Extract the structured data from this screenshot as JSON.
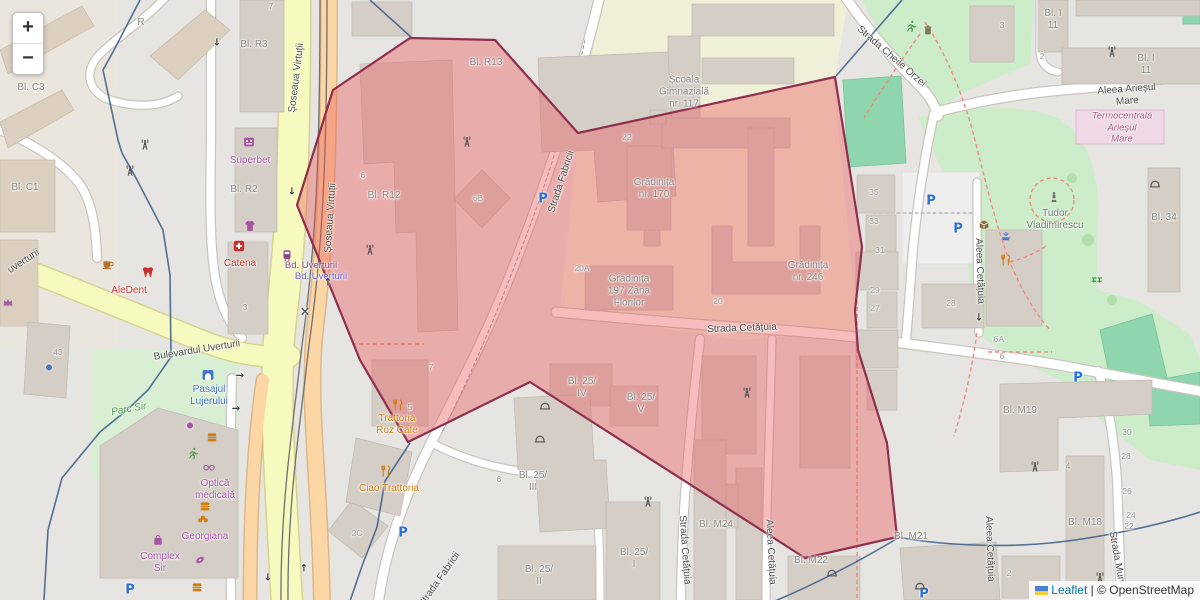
{
  "controls": {
    "zoom_in": "+",
    "zoom_out": "−"
  },
  "attribution": {
    "leaflet": "Leaflet",
    "separator": " | ",
    "osm": "© OpenStreetMap"
  },
  "colors": {
    "selection_fill": "rgba(235,90,90,0.40)",
    "selection_border": "#8f2f4e",
    "boundary_blue": "#41628c",
    "road_orange": "#fcd6a4",
    "road_yellow": "#f7fabf",
    "park_green": "#cdecca",
    "pitch_green": "#8fd6ae",
    "school_cream": "#f0f0d8",
    "building_gray": "#d4cec6",
    "street_label": "#4e4e4e",
    "bld_label": "#8a8782",
    "num_label": "#9a9a9a",
    "poi_purple": "#a653a6",
    "poi_red": "#cc342c",
    "poi_orange": "#cf7c12",
    "poi_blue": "#4273c4",
    "park_label": "#4f9a4f",
    "park_name": "#6e8272",
    "industrial_label": "#b05c85",
    "transit_purple": "#8d3f8d",
    "transit_blue": "#6a5ad0",
    "parking_blue": "#2a6fdb",
    "attr_link": "#0078a8"
  },
  "labels": [
    {
      "t": "Șoseaua Virtuții",
      "x": 297,
      "y": 78,
      "r": -83,
      "c": "street"
    },
    {
      "t": "Șoseaua Virtuții",
      "x": 331,
      "y": 218,
      "r": -86,
      "c": "street"
    },
    {
      "t": "Bulevardul Uverturii",
      "x": 197,
      "y": 351,
      "r": -9,
      "c": "street"
    },
    {
      "t": "uverturii",
      "x": 24,
      "y": 262,
      "r": -33,
      "c": "street"
    },
    {
      "t": "Strada Fabricii",
      "x": 562,
      "y": 182,
      "r": -72,
      "c": "street"
    },
    {
      "t": "Strada Fabricii",
      "x": 440,
      "y": 580,
      "r": -55,
      "c": "street"
    },
    {
      "t": "Strada Cheile Orzei",
      "x": 891,
      "y": 57,
      "r": 41,
      "c": "street"
    },
    {
      "t": "Aleea Arieșul Mare",
      "x": 1127,
      "y": 96,
      "r": -4,
      "c": "street"
    },
    {
      "t": "Strada Cetățuia",
      "x": 742,
      "y": 329,
      "r": -2,
      "c": "street"
    },
    {
      "t": "Strada Cetățuia",
      "x": 684,
      "y": 550,
      "r": 86,
      "c": "street"
    },
    {
      "t": "Aleea Cetățuia",
      "x": 770,
      "y": 552,
      "r": 87,
      "c": "street"
    },
    {
      "t": "Aleea Cetățuia",
      "x": 979,
      "y": 271,
      "r": 88,
      "c": "street"
    },
    {
      "t": "Aleea Cetățuia",
      "x": 989,
      "y": 549,
      "r": 88,
      "c": "street"
    },
    {
      "t": "Strada Mun",
      "x": 1116,
      "y": 557,
      "r": 80,
      "c": "street"
    },
    {
      "t": "Bd. Uverturii",
      "x": 311,
      "y": 266,
      "c": "transit"
    },
    {
      "t": "Bd. Uverturii",
      "x": 321,
      "y": 277,
      "c": "transit2"
    },
    {
      "t": "Bl. C3",
      "x": 31,
      "y": 88,
      "c": "bld"
    },
    {
      "t": "Bl. C1",
      "x": 25,
      "y": 188,
      "c": "bld"
    },
    {
      "t": "R",
      "x": 141,
      "y": 23,
      "c": "bld"
    },
    {
      "t": "Bl. R3",
      "x": 254,
      "y": 45,
      "c": "bld"
    },
    {
      "t": "Bl. R2",
      "x": 244,
      "y": 190,
      "c": "bld"
    },
    {
      "t": "Bl. R13",
      "x": 486,
      "y": 63,
      "c": "bld"
    },
    {
      "t": "Bl. R12",
      "x": 384,
      "y": 196,
      "c": "bld"
    },
    {
      "t": "Bl. I\n11",
      "x": 1053,
      "y": 20,
      "c": "bld"
    },
    {
      "t": "Bl. I\n11",
      "x": 1146,
      "y": 65,
      "c": "bld"
    },
    {
      "t": "Bl. 34",
      "x": 1164,
      "y": 218,
      "c": "bld"
    },
    {
      "t": "Bl. M19",
      "x": 1020,
      "y": 411,
      "c": "bld"
    },
    {
      "t": "Bl. M18",
      "x": 1085,
      "y": 523,
      "c": "bld"
    },
    {
      "t": "Bl. M21",
      "x": 911,
      "y": 537,
      "c": "bld"
    },
    {
      "t": "Bl. M22",
      "x": 811,
      "y": 561,
      "c": "bld"
    },
    {
      "t": "Bl. M24",
      "x": 716,
      "y": 525,
      "c": "bld"
    },
    {
      "t": "Bl. 25/\nIV",
      "x": 582,
      "y": 388,
      "c": "bld"
    },
    {
      "t": "Bl. 25/\nV",
      "x": 641,
      "y": 404,
      "c": "bld"
    },
    {
      "t": "Bl. 25/\nIII",
      "x": 533,
      "y": 482,
      "c": "bld"
    },
    {
      "t": "Bl. 25/\nII",
      "x": 539,
      "y": 576,
      "c": "bld"
    },
    {
      "t": "Bl. 25/\nI",
      "x": 634,
      "y": 559,
      "c": "bld"
    },
    {
      "t": "Școala\nGimnazială\nnr. 117",
      "x": 684,
      "y": 93,
      "c": "bld"
    },
    {
      "t": "Grădinița\nnr. 170",
      "x": 654,
      "y": 189,
      "c": "bld"
    },
    {
      "t": "Grădinița\n197 Zâna\nFlorilor",
      "x": 629,
      "y": 292,
      "c": "bld"
    },
    {
      "t": "Grădinița\nnr. 246",
      "x": 808,
      "y": 272,
      "c": "bld"
    },
    {
      "t": "Superbet",
      "x": 250,
      "y": 161,
      "c": "poi-purple"
    },
    {
      "t": "Catena",
      "x": 240,
      "y": 264,
      "c": "poi-red"
    },
    {
      "t": "AleDent",
      "x": 129,
      "y": 291,
      "c": "poi-red"
    },
    {
      "t": "Optică\nmedicală",
      "x": 215,
      "y": 490,
      "c": "poi-purple"
    },
    {
      "t": "Georgiana",
      "x": 205,
      "y": 537,
      "c": "poi-purple"
    },
    {
      "t": "Complex\nSir",
      "x": 160,
      "y": 563,
      "c": "poi-purple"
    },
    {
      "t": "Ciao Trattoria",
      "x": 389,
      "y": 489,
      "c": "poi-orange"
    },
    {
      "t": "Trattoria\nRoz Café",
      "x": 397,
      "y": 425,
      "c": "poi-orange"
    },
    {
      "t": "Pasajul\nLujerului",
      "x": 209,
      "y": 396,
      "c": "poi-blue"
    },
    {
      "t": "Parc Sir",
      "x": 129,
      "y": 410,
      "r": -10,
      "c": "park-label"
    },
    {
      "t": "Tudor\nVladimirescu",
      "x": 1055,
      "y": 220,
      "c": "park-name"
    },
    {
      "t": "Termocentrala\nArieșul\nMare",
      "x": 1122,
      "y": 128,
      "c": "industrial"
    },
    {
      "t": "7",
      "x": 271,
      "y": 6,
      "c": "num"
    },
    {
      "t": "6",
      "x": 363,
      "y": 175,
      "c": "num"
    },
    {
      "t": "6B",
      "x": 478,
      "y": 198,
      "c": "num"
    },
    {
      "t": "22",
      "x": 627,
      "y": 137,
      "c": "num"
    },
    {
      "t": "20A",
      "x": 582,
      "y": 268,
      "c": "num"
    },
    {
      "t": "20",
      "x": 718,
      "y": 301,
      "c": "num"
    },
    {
      "t": "7",
      "x": 431,
      "y": 367,
      "c": "num"
    },
    {
      "t": "5",
      "x": 410,
      "y": 407,
      "c": "num"
    },
    {
      "t": "2C",
      "x": 357,
      "y": 533,
      "c": "num"
    },
    {
      "t": "6",
      "x": 499,
      "y": 479,
      "c": "num"
    },
    {
      "t": "35",
      "x": 874,
      "y": 192,
      "c": "num"
    },
    {
      "t": "33",
      "x": 874,
      "y": 221,
      "c": "num"
    },
    {
      "t": "31",
      "x": 880,
      "y": 250,
      "c": "num"
    },
    {
      "t": "29",
      "x": 875,
      "y": 290,
      "c": "num"
    },
    {
      "t": "27",
      "x": 875,
      "y": 308,
      "c": "num"
    },
    {
      "t": "28",
      "x": 951,
      "y": 303,
      "c": "num"
    },
    {
      "t": "3",
      "x": 1002,
      "y": 25,
      "c": "num"
    },
    {
      "t": "2",
      "x": 1042,
      "y": 56,
      "c": "num"
    },
    {
      "t": "6A",
      "x": 999,
      "y": 339,
      "c": "num"
    },
    {
      "t": "6",
      "x": 1002,
      "y": 356,
      "c": "num"
    },
    {
      "t": "43",
      "x": 58,
      "y": 352,
      "c": "num"
    },
    {
      "t": "3",
      "x": 245,
      "y": 307,
      "c": "num"
    },
    {
      "t": "30",
      "x": 1127,
      "y": 432,
      "c": "num"
    },
    {
      "t": "28",
      "x": 1126,
      "y": 456,
      "c": "num"
    },
    {
      "t": "26",
      "x": 1127,
      "y": 491,
      "c": "num"
    },
    {
      "t": "24",
      "x": 1131,
      "y": 515,
      "c": "num"
    },
    {
      "t": "22",
      "x": 1129,
      "y": 526,
      "c": "num"
    },
    {
      "t": "4",
      "x": 1068,
      "y": 466,
      "c": "num"
    },
    {
      "t": "2",
      "x": 1009,
      "y": 573,
      "c": "num"
    }
  ],
  "icons": [
    {
      "n": "parking-icon",
      "g": "P",
      "c": "#2a6fdb",
      "fs": 13,
      "x": 543,
      "y": 199
    },
    {
      "n": "parking-icon",
      "g": "P",
      "c": "#2a6fdb",
      "fs": 13,
      "x": 931,
      "y": 201
    },
    {
      "n": "parking-icon",
      "g": "P",
      "c": "#2a6fdb",
      "fs": 13,
      "x": 958,
      "y": 229
    },
    {
      "n": "parking-icon",
      "g": "P",
      "c": "#2a6fdb",
      "fs": 13,
      "x": 403,
      "y": 533
    },
    {
      "n": "parking-icon",
      "g": "P",
      "c": "#2a6fdb",
      "fs": 13,
      "x": 1078,
      "y": 378
    },
    {
      "n": "parking-icon",
      "g": "P",
      "c": "#2a6fdb",
      "fs": 13,
      "x": 130,
      "y": 590
    },
    {
      "n": "parking-icon",
      "g": "P",
      "c": "#2a6fdb",
      "fs": 13,
      "x": 924,
      "y": 594
    },
    {
      "n": "railway-crossing-icon",
      "g": "×",
      "c": "#5a5a5a",
      "fs": 13,
      "x": 305,
      "y": 312
    },
    {
      "n": "oneway-arrow-icon",
      "g": "↓",
      "c": "#3c3c3c",
      "fs": 10,
      "x": 217,
      "y": 43
    },
    {
      "n": "oneway-arrow-icon",
      "g": "↓",
      "c": "#3c3c3c",
      "fs": 10,
      "x": 292,
      "y": 192
    },
    {
      "n": "oneway-arrow-icon",
      "g": "↓",
      "c": "#3c3c3c",
      "fs": 10,
      "x": 268,
      "y": 578
    },
    {
      "n": "oneway-arrow-icon",
      "g": "↓",
      "c": "#3c3c3c",
      "fs": 10,
      "x": 979,
      "y": 318
    },
    {
      "n": "oneway-arrow-icon",
      "g": "↑",
      "c": "#3c3c3c",
      "fs": 10,
      "x": 328,
      "y": 283
    },
    {
      "n": "oneway-arrow-icon",
      "g": "↑",
      "c": "#3c3c3c",
      "fs": 10,
      "x": 304,
      "y": 569
    },
    {
      "n": "oneway-arrow-icon",
      "g": "→",
      "c": "#3c3c3c",
      "fs": 10,
      "x": 240,
      "y": 376
    },
    {
      "n": "oneway-arrow-icon",
      "g": "→",
      "c": "#3c3c3c",
      "fs": 10,
      "x": 236,
      "y": 409
    },
    {
      "n": "poi-dot-icon",
      "g": "●",
      "c": "#4a78c8",
      "fs": 8,
      "x": 49,
      "y": 367
    },
    {
      "n": "poi-dot-icon",
      "g": "●",
      "c": "#a653a6",
      "fs": 8,
      "x": 190,
      "y": 425
    },
    {
      "n": "antenna-icon",
      "s": "antenna",
      "x": 145,
      "y": 145
    },
    {
      "n": "antenna-icon",
      "s": "antenna",
      "x": 130,
      "y": 171
    },
    {
      "n": "antenna-icon",
      "s": "antenna",
      "x": 467,
      "y": 142
    },
    {
      "n": "antenna-icon",
      "s": "antenna",
      "x": 370,
      "y": 250
    },
    {
      "n": "antenna-icon",
      "s": "antenna",
      "x": 648,
      "y": 502
    },
    {
      "n": "antenna-icon",
      "s": "antenna",
      "x": 747,
      "y": 393
    },
    {
      "n": "antenna-icon",
      "s": "antenna",
      "x": 1035,
      "y": 467
    },
    {
      "n": "antenna-icon",
      "s": "antenna",
      "x": 1100,
      "y": 578
    },
    {
      "n": "antenna-icon",
      "s": "antenna",
      "x": 1112,
      "y": 52
    },
    {
      "n": "arch-icon",
      "s": "arch",
      "x": 545,
      "y": 405
    },
    {
      "n": "arch-icon",
      "s": "arch",
      "x": 540,
      "y": 438
    },
    {
      "n": "arch-icon",
      "s": "arch",
      "x": 832,
      "y": 572
    },
    {
      "n": "arch-icon",
      "s": "arch",
      "x": 920,
      "y": 585
    },
    {
      "n": "arch-icon",
      "s": "arch",
      "x": 1155,
      "y": 183
    },
    {
      "n": "pharmacy-icon",
      "s": "firstaid",
      "x": 239,
      "y": 246
    },
    {
      "n": "dentist-icon",
      "s": "tooth",
      "x": 148,
      "y": 272
    },
    {
      "n": "cafe-icon",
      "s": "coffee",
      "x": 108,
      "y": 264
    },
    {
      "n": "casino-icon",
      "s": "casino",
      "x": 249,
      "y": 142
    },
    {
      "n": "clothes-shop-icon",
      "s": "shop",
      "x": 250,
      "y": 226
    },
    {
      "n": "tram-stop-icon",
      "s": "tram",
      "x": 287,
      "y": 255
    },
    {
      "n": "tunnel-icon",
      "s": "tunnel",
      "x": 208,
      "y": 375
    },
    {
      "n": "monument-icon",
      "s": "statue",
      "x": 1054,
      "y": 197
    },
    {
      "n": "fountain-icon",
      "s": "fountain",
      "x": 1006,
      "y": 237
    },
    {
      "n": "restaurant-icon",
      "s": "restaurant",
      "x": 1006,
      "y": 260
    },
    {
      "n": "restaurant-icon",
      "s": "restaurant",
      "x": 398,
      "y": 405
    },
    {
      "n": "restaurant-icon",
      "s": "restaurant",
      "x": 386,
      "y": 471
    },
    {
      "n": "parcel-locker-icon",
      "s": "parcel",
      "x": 984,
      "y": 225
    },
    {
      "n": "shop-bag-icon",
      "s": "bag",
      "x": 158,
      "y": 540
    },
    {
      "n": "optician-icon",
      "s": "glasses",
      "x": 209,
      "y": 467
    },
    {
      "n": "fitness-icon",
      "s": "runner",
      "x": 193,
      "y": 453
    },
    {
      "n": "playground-icon",
      "s": "runner",
      "x": 911,
      "y": 26
    },
    {
      "n": "bakery-icon",
      "s": "bakery",
      "x": 203,
      "y": 519
    },
    {
      "n": "pastry-icon",
      "s": "donut",
      "x": 200,
      "y": 560
    },
    {
      "n": "fast-food-icon",
      "s": "fastfood",
      "x": 212,
      "y": 437
    },
    {
      "n": "fast-food-icon",
      "s": "fastfood",
      "x": 205,
      "y": 506
    },
    {
      "n": "fast-food-icon",
      "s": "fastfood",
      "x": 197,
      "y": 587
    },
    {
      "n": "waste-basket-icon",
      "s": "trash",
      "x": 928,
      "y": 30
    },
    {
      "n": "picnic-icon",
      "s": "picnic",
      "x": 1097,
      "y": 278
    },
    {
      "n": "jeweller-icon",
      "s": "crown",
      "x": 8,
      "y": 302
    }
  ]
}
